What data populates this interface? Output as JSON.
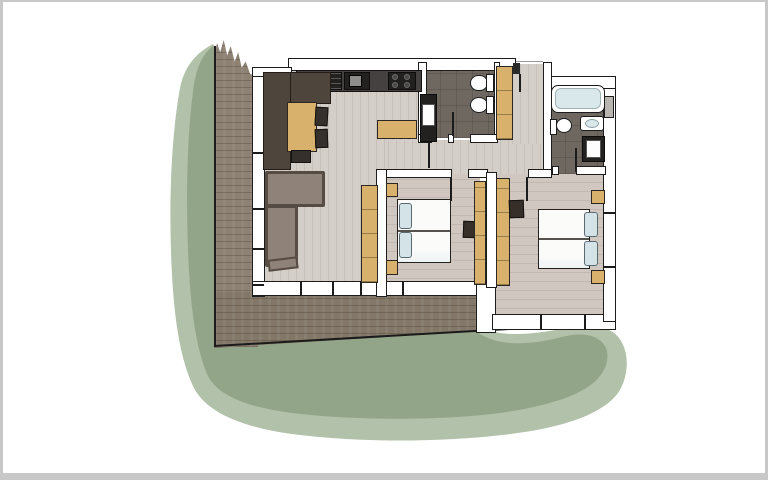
{
  "frame": {
    "page_bg": "#ffffff",
    "frame_border": "#c8c8c8"
  },
  "palette": {
    "page_bg": "#ffffff",
    "frame_border": "#c8c8c8",
    "green_light": "#b2c1aa",
    "green_dark": "#93a589",
    "deck_wood": "#8c8172",
    "deck_wood_dark": "#837868",
    "floor_light": "#d4cec8",
    "floor_bedroom": "#cfc7c0",
    "bath_tile": "#6e6861",
    "wall_fill": "#ffffff",
    "wall_line": "#1c1c1c",
    "counter_dark": "#454140",
    "appliance_black": "#232120",
    "cabinet_brown": "#4e453d",
    "wood_tan": "#d8b26c",
    "sofa_taupe": "#8e8279",
    "sofa_outline": "#564c44",
    "mattress_white": "#fbfbfa",
    "pillow_blue": "#d4e3e7",
    "tub_water": "#d9e8ea",
    "tv_dark": "#362f29",
    "niche_gray": "#b9b5b1"
  },
  "floor_plan": {
    "type": "hand-drawn apartment floor plan with garden shadow",
    "rooms": [
      "terrace-deck",
      "living-kitchen",
      "bathroom-1",
      "entrance-hall",
      "bathroom-2",
      "corridor",
      "bedroom-1",
      "bedroom-2"
    ],
    "furniture": [
      "kitchen-counter",
      "dishwasher",
      "kitchen-sink",
      "stove",
      "kitchen-cabinet",
      "dining-table",
      "chairs",
      "sideboard",
      "corner-sofa",
      "wardrobes",
      "double-bed-1",
      "double-bed-2",
      "nightstands",
      "tv-units",
      "bathtub",
      "toilets",
      "washbasins"
    ]
  }
}
